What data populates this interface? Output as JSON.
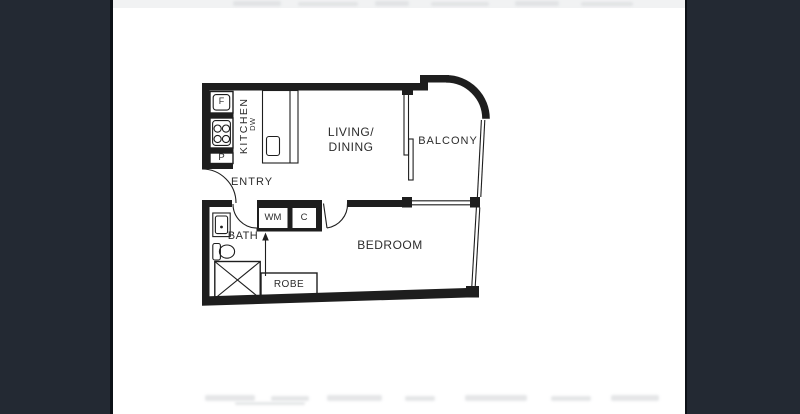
{
  "theme": {
    "bg": "#ffffff",
    "pillar_color": "#232933",
    "pillar_edge": "#0d1117",
    "line_color": "#1e1e1e",
    "label_color": "#2c2c2c"
  },
  "floorplan": {
    "rooms": {
      "kitchen": "KITCHEN",
      "entry": "ENTRY",
      "living_dining_line1": "LIVING/",
      "living_dining_line2": "DINING",
      "balcony": "BALCONY",
      "bath": "BATH",
      "bedroom": "BEDROOM"
    },
    "fixtures": {
      "fridge_label": "F",
      "pantry_label": "P",
      "dishwasher_label": "DW",
      "washing_machine_label": "WM",
      "cupboard_label": "C",
      "robe_label": "ROBE"
    }
  }
}
